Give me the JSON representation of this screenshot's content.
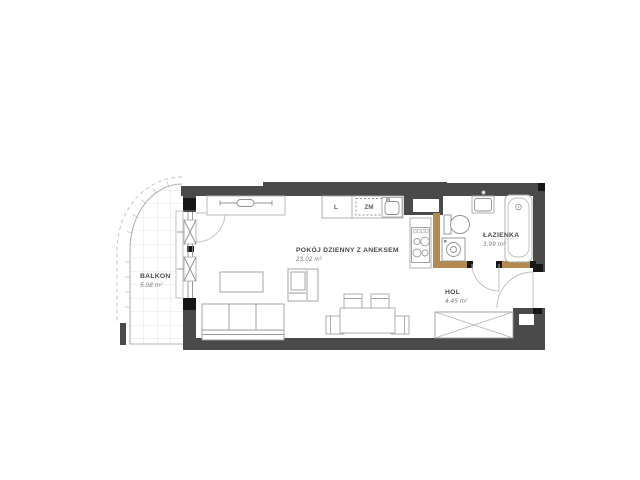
{
  "rooms": {
    "balkon": {
      "name": "BALKON",
      "area": "5.08 m²"
    },
    "pokoj": {
      "name": "POKÓJ DZIENNY Z ANEKSEM",
      "area": "23.02 m²"
    },
    "lazienka": {
      "name": "ŁAZIENKA",
      "area": "3.99 m²"
    },
    "hol": {
      "name": "HOL",
      "area": "4.45 m²"
    }
  },
  "appliances": {
    "fridge_label": "L",
    "dishwasher_label": "ZM"
  },
  "colors": {
    "wall": "#4a4a4a",
    "marker": "#161616",
    "partition": "#b28a50",
    "furniture": "#9b9b9b",
    "fixture": "#8f8f8f",
    "line_light": "#b5b5b5",
    "dash": "#c2c2c2",
    "grid": "#dcdcdc",
    "door": "#bdbdbd",
    "label": "#4a4a4a",
    "area_label": "#7a7a7a",
    "appliance_label": "#5f5f5f",
    "background": "#ffffff"
  }
}
